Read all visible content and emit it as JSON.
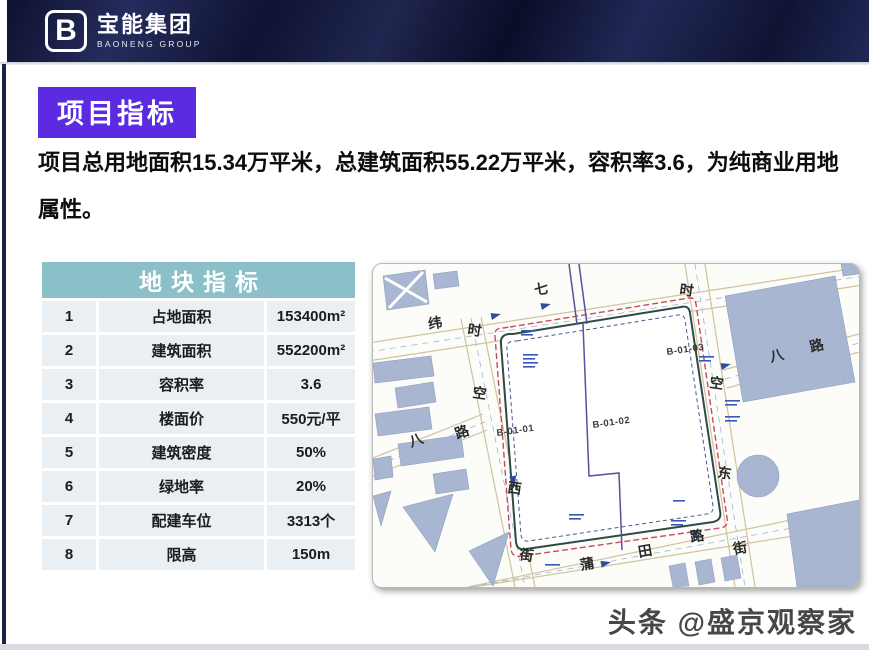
{
  "header": {
    "logo_letter": "B",
    "company_cn": "宝能集团",
    "company_en": "BAONENG GROUP"
  },
  "page": {
    "section_title": "项目指标",
    "intro": "项目总用地面积15.34万平米，总建筑面积55.22万平米，容积率3.6，为纯商业用地属性。"
  },
  "table": {
    "title": "地块指标",
    "rows": [
      {
        "no": "1",
        "label": "占地面积",
        "value": "153400m²"
      },
      {
        "no": "2",
        "label": "建筑面积",
        "value": "552200m²"
      },
      {
        "no": "3",
        "label": "容积率",
        "value": "3.6"
      },
      {
        "no": "4",
        "label": "楼面价",
        "value": "550元/平"
      },
      {
        "no": "5",
        "label": "建筑密度",
        "value": "50%"
      },
      {
        "no": "6",
        "label": "绿地率",
        "value": "20%"
      },
      {
        "no": "7",
        "label": "配建车位",
        "value": "3313个"
      },
      {
        "no": "8",
        "label": "限高",
        "value": "150m"
      }
    ]
  },
  "map": {
    "parcels": [
      "B-01-01",
      "B-01-02",
      "B-01-03"
    ],
    "street_labels": [
      "七",
      "纬",
      "时",
      "空",
      "西",
      "街",
      "八",
      "路",
      "蒲",
      "田",
      "路",
      "街",
      "时",
      "空",
      "东",
      "八",
      "路"
    ]
  },
  "footer": {
    "watermark": "头条 @盛京观察家"
  },
  "colors": {
    "accent_purple": "#5A2BE1",
    "band_navy": "#1A2049",
    "table_header_teal": "#8CC0C9",
    "table_row_bg": "#E9EFF3",
    "map_building": "#A8B6D2",
    "parcel_boundary_red": "#C84A62",
    "parcel_divider_purple": "#5C4E9E"
  }
}
